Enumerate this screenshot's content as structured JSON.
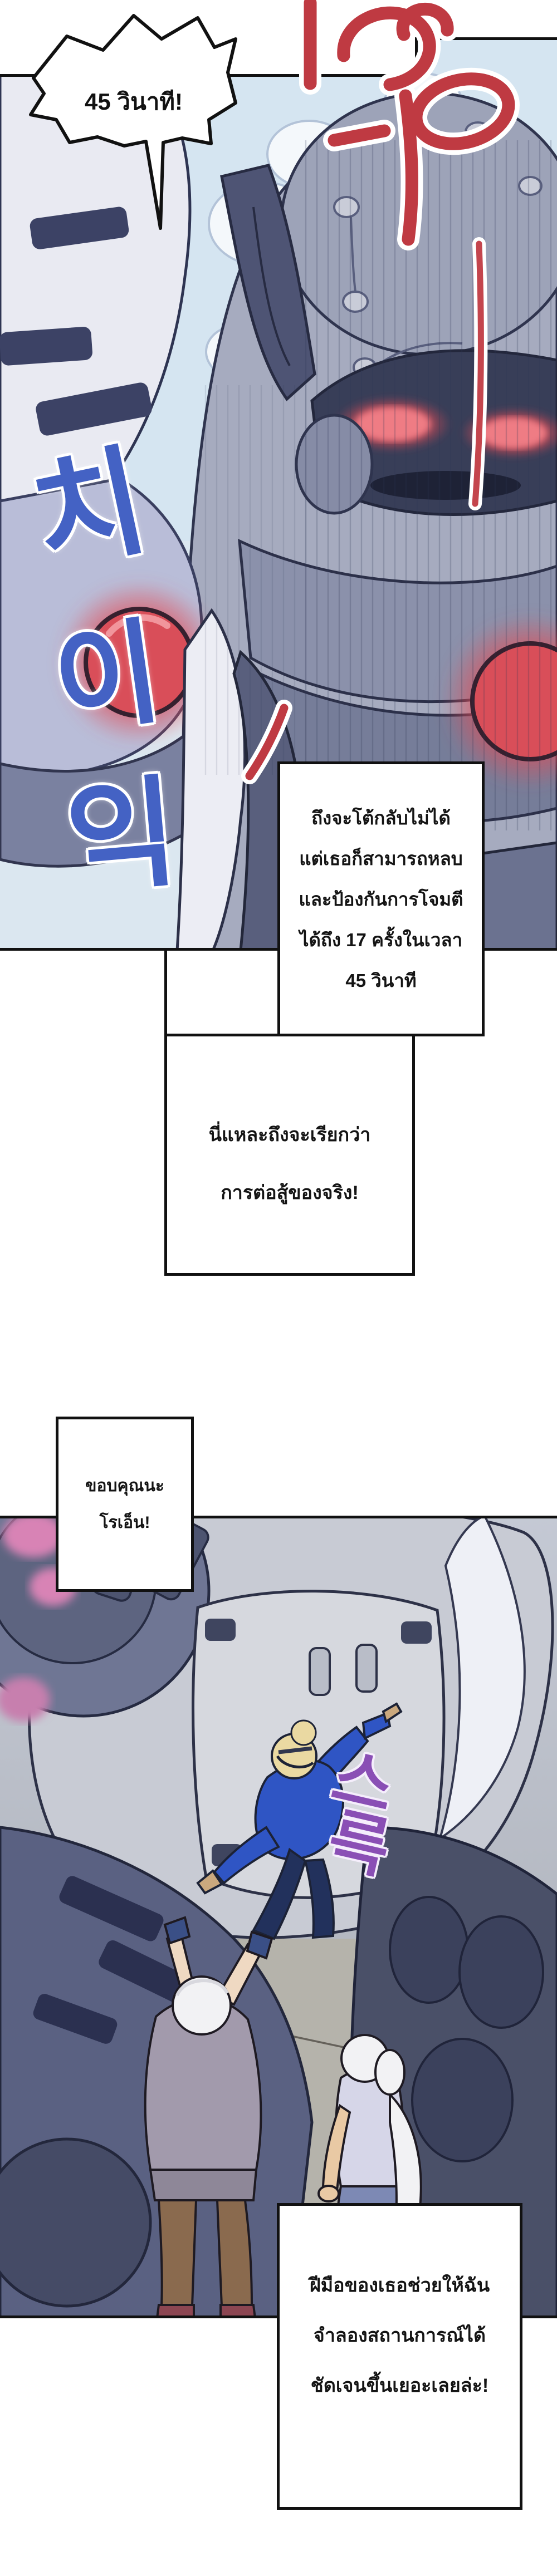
{
  "comic": {
    "bubble_45s": {
      "text": "45 วินาที!"
    },
    "box_counter": {
      "lines": [
        "ถึงจะโต้กลับไม่ได้",
        "แต่เธอก็สามารถหลบ",
        "และป้องกันการโจมตี",
        "ได้ถึง 17 ครั้งในเวลา",
        "45 วินาที"
      ]
    },
    "box_real_fight": {
      "lines": [
        "นี่แหละถึงจะเรียกว่า",
        "การต่อสู้ของจริง!"
      ]
    },
    "box_thanks": {
      "lines": [
        "ขอบคุณนะ",
        "โรเอ็น!"
      ]
    },
    "box_simulation": {
      "lines": [
        "ฝีมือของเธอช่วยให้ฉัน",
        "จำลองสถานการณ์ได้",
        "ชัดเจนขึ้นเยอะเลยล่ะ!"
      ]
    },
    "sfx": {
      "hiss_vertical_chars": [
        "치",
        "이",
        "익"
      ],
      "slide_chars": [
        "스",
        "륵"
      ],
      "colors": {
        "hiss_blue": "#4462c4",
        "slide_purple": "#8a4fb5",
        "roar_red": "#bf3a42",
        "panel_border": "#111111",
        "sky": "#d5e5f1"
      }
    }
  }
}
